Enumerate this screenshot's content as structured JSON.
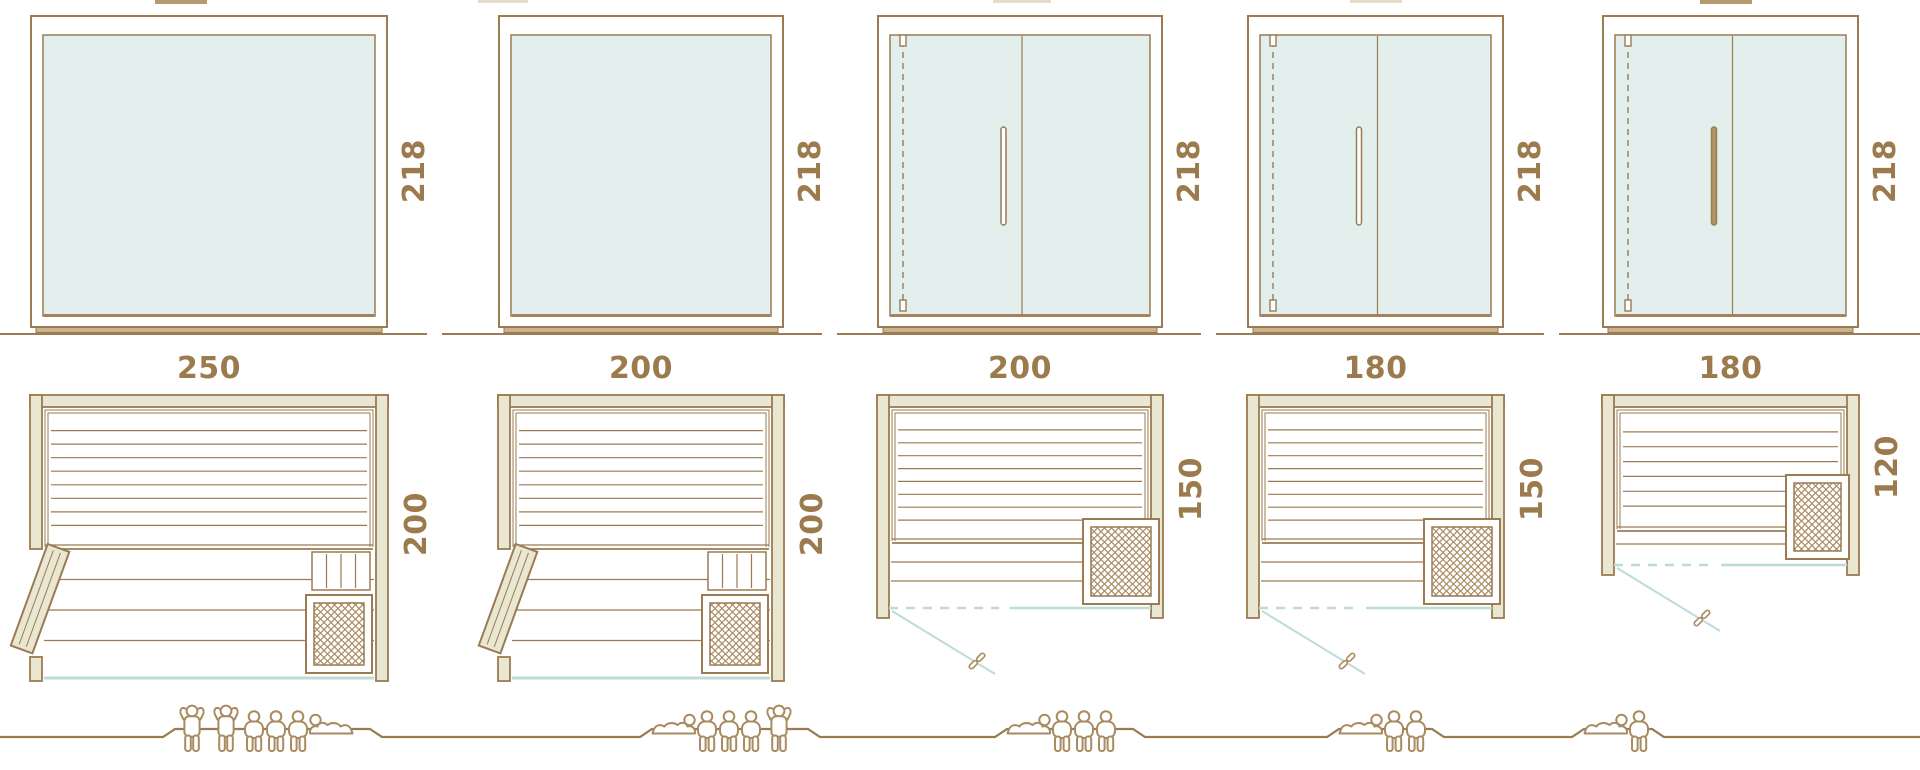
{
  "colors": {
    "line": "#9a7b52",
    "line_soft": "#ab906b",
    "wall_fill": "#e9e6d2",
    "glass_fill": "#e2efec",
    "glass_edge": "#a5825a",
    "teal": "#bedcd6",
    "dimension_text": "#9b7b4e",
    "people": "#a98b60",
    "sill_fill": "#cbb28c"
  },
  "models": [
    {
      "width_label": "250",
      "width_cm": 250,
      "elevation": {
        "height_label": "218",
        "height_cm": 218,
        "style": "fixed-glass-front",
        "has_door": false,
        "handle_filled": false
      },
      "plan": {
        "depth_label": "200",
        "depth_cm": 200,
        "door_style": "hinged-wood-door-left",
        "heater": "front-right-corner",
        "has_vertical_slats": true
      },
      "capacity": {
        "standing": 2,
        "sitting": 3,
        "lying": 1,
        "figures": [
          "standing",
          "standing",
          "sitting",
          "sitting",
          "sitting",
          "lying-head-left"
        ]
      }
    },
    {
      "width_label": "200",
      "width_cm": 200,
      "elevation": {
        "height_label": "218",
        "height_cm": 218,
        "style": "fixed-glass-front",
        "has_door": false,
        "handle_filled": false
      },
      "plan": {
        "depth_label": "200",
        "depth_cm": 200,
        "door_style": "hinged-wood-door-left",
        "heater": "front-right-corner",
        "has_vertical_slats": true
      },
      "capacity": {
        "standing": 1,
        "sitting": 3,
        "lying": 1,
        "figures": [
          "lying-head-right",
          "sitting",
          "sitting",
          "sitting",
          "standing"
        ]
      }
    },
    {
      "width_label": "200",
      "width_cm": 200,
      "elevation": {
        "height_label": "218",
        "height_cm": 218,
        "style": "glass-front-with-door",
        "has_door": true,
        "handle_filled": false
      },
      "plan": {
        "depth_label": "150",
        "depth_cm": 150,
        "door_style": "glass-door-swing-out",
        "heater": "front-right-corner",
        "has_vertical_slats": false
      },
      "capacity": {
        "standing": 0,
        "sitting": 3,
        "lying": 1,
        "figures": [
          "lying-head-right",
          "sitting",
          "sitting",
          "sitting"
        ]
      }
    },
    {
      "width_label": "180",
      "width_cm": 180,
      "elevation": {
        "height_label": "218",
        "height_cm": 218,
        "style": "glass-front-with-door",
        "has_door": true,
        "handle_filled": false
      },
      "plan": {
        "depth_label": "150",
        "depth_cm": 150,
        "door_style": "glass-door-swing-out",
        "heater": "front-right-corner",
        "has_vertical_slats": false
      },
      "capacity": {
        "standing": 0,
        "sitting": 2,
        "lying": 1,
        "figures": [
          "lying-head-right",
          "sitting",
          "sitting"
        ]
      }
    },
    {
      "width_label": "180",
      "width_cm": 180,
      "elevation": {
        "height_label": "218",
        "height_cm": 218,
        "style": "glass-front-with-door",
        "has_door": true,
        "handle_filled": true
      },
      "plan": {
        "depth_label": "120",
        "depth_cm": 120,
        "door_style": "glass-door-swing-out",
        "heater": "right-side",
        "has_vertical_slats": false
      },
      "capacity": {
        "standing": 0,
        "sitting": 1,
        "lying": 1,
        "figures": [
          "lying-head-right",
          "sitting"
        ]
      }
    }
  ]
}
